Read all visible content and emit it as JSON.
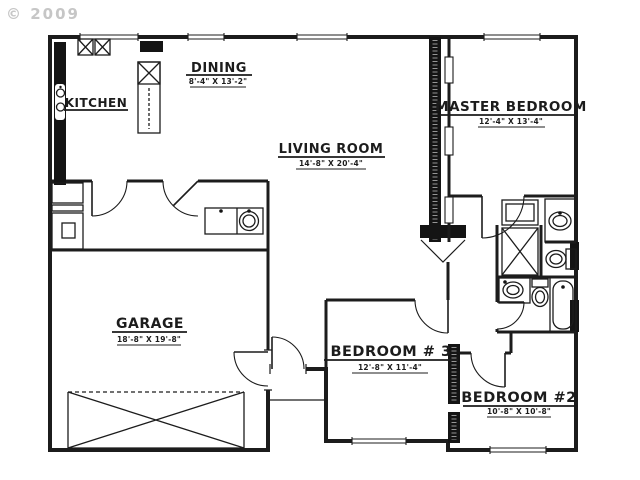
{
  "watermark": {
    "text": "© 2009"
  },
  "rooms": [
    {
      "name": "KITCHEN",
      "dim": ""
    },
    {
      "name": "DINING",
      "dim": "8'-4\" X 13'-2\""
    },
    {
      "name": "LIVING ROOM",
      "dim": "14'-8\" X 20'-4\""
    },
    {
      "name": "MASTER BEDROOM",
      "dim": "12'-4\" X 13'-4\""
    },
    {
      "name": "GARAGE",
      "dim": "18'-8\" X 19'-8\""
    },
    {
      "name": "BEDROOM # 3",
      "dim": "12'-8\" X 11'-4\""
    },
    {
      "name": "BEDROOM #2",
      "dim": "10'-8\" X 10'-8\""
    }
  ],
  "colors": {
    "line": "#1c1c1c",
    "watermark": "#c6c6c6",
    "background": "#ffffff"
  }
}
